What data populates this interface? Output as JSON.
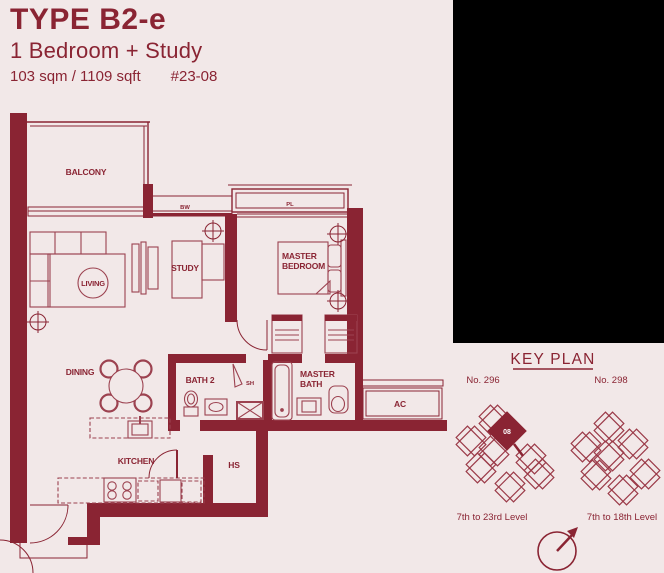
{
  "colors": {
    "background": "#f2e8e8",
    "accent_maroon": "#8a2433",
    "furniture_line": "#9c4250",
    "black_panel": "#000000",
    "highlight_unit_text": "#ffffff"
  },
  "header": {
    "type_title": "TYPE B2-e",
    "subtitle": "1 Bedroom + Study",
    "area": "103 sqm / 1109 sqft",
    "unit_number": "#23-08"
  },
  "floor_plan": {
    "labels": {
      "balcony": "BALCONY",
      "living": "LIVING",
      "study": "STUDY",
      "master_bedroom_line1": "MASTER",
      "master_bedroom_line2": "BEDROOM",
      "dining": "DINING",
      "bath2": "BATH 2",
      "shower": "SH",
      "master_bath_line1": "MASTER",
      "master_bath_line2": "BATH",
      "ac_ledge": "AC",
      "kitchen": "KITCHEN",
      "household_shelter": "HS",
      "planter": "PL",
      "bay_window": "BW"
    }
  },
  "key_plan": {
    "title": "KEY PLAN",
    "left_building": {
      "number": "No. 296",
      "levels": "7th to 23rd Level",
      "highlighted_unit": "08"
    },
    "right_building": {
      "number": "No. 298",
      "levels": "7th to 18th Level"
    }
  }
}
